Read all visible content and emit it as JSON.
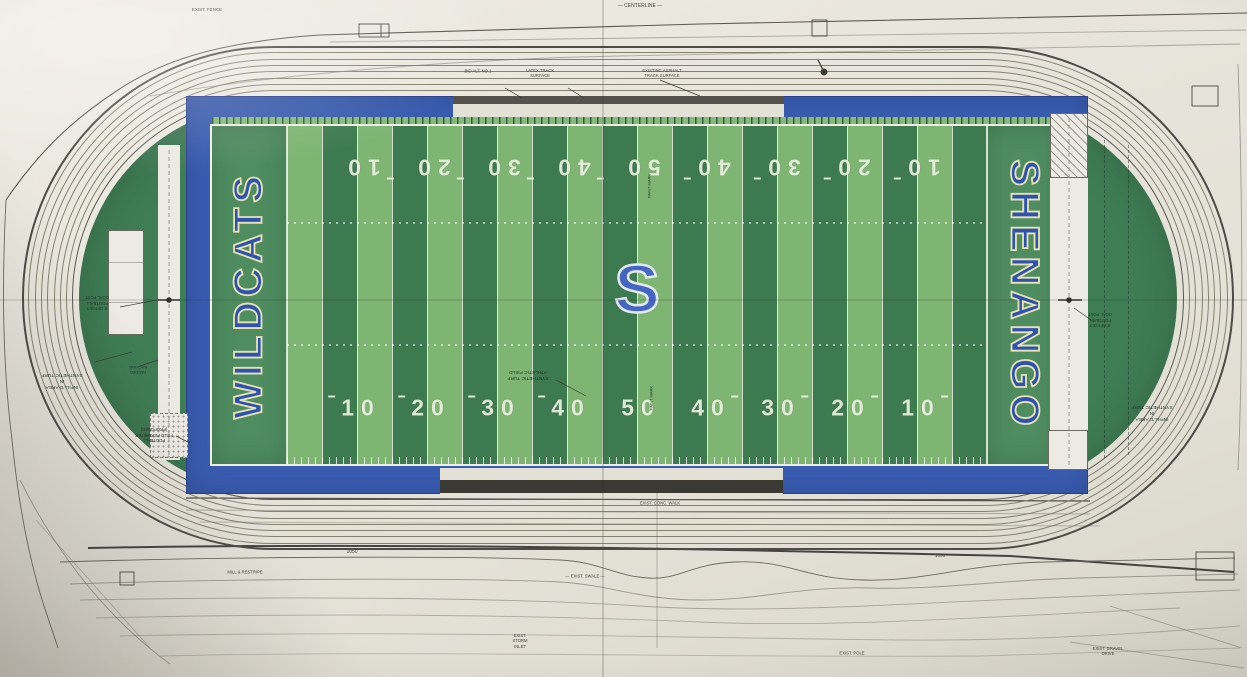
{
  "document": {
    "type": "photographed site plan drawing",
    "subject": "Shenango Wildcats football field and running track"
  },
  "field": {
    "left_endzone_text": "WILDCATS",
    "right_endzone_text": "SHENANGO",
    "center_logo_letter": "S",
    "yard_numbers_top": [
      "10",
      "20",
      "30",
      "40",
      "50",
      "40",
      "30",
      "20",
      "10"
    ],
    "yard_numbers_bottom": [
      "10",
      "20",
      "30",
      "40",
      "50",
      "40",
      "30",
      "20",
      "10"
    ],
    "colors": {
      "stripe_light": "#7eb573",
      "stripe_dark": "#3e7a50",
      "endzone_green": "#4f8c60",
      "infield_green": "#3f7d55",
      "apron_blue": "#3a5db2",
      "letter_blue": "#2d52b4",
      "letter_outline": "#e8e2b0",
      "logo_blue": "#4565c5",
      "line_white": "#f0efe6"
    }
  },
  "track": {
    "lane_count": 8,
    "lane_line_color": "#85836f"
  },
  "icons": [
    {
      "name": "goal-post-icon",
      "meaning": "football goal post plan symbol"
    },
    {
      "name": "benchmark-icon",
      "meaning": "survey benchmark dot"
    }
  ],
  "annotations": [
    {
      "text": "— CENTERLINE —",
      "x": 640,
      "y": 6,
      "rot": 0,
      "size": 5,
      "color": "#45443c"
    },
    {
      "text": "EXIST. FENCE",
      "x": 207,
      "y": 10,
      "rot": 0,
      "size": 4.5,
      "color": "#45443c"
    },
    {
      "text": "BID ALT. NO.1",
      "x": 478,
      "y": 71,
      "rot": 0,
      "size": 4.2,
      "color": "#45443c"
    },
    {
      "text": "LATEX TRACK\nSURFACE",
      "x": 540,
      "y": 73,
      "rot": 0,
      "size": 4.2,
      "color": "#45443c"
    },
    {
      "text": "EXISTING ASPHALT\nTRACK SURFACE",
      "x": 662,
      "y": 73,
      "rot": 0,
      "size": 4.2,
      "color": "#45443c"
    },
    {
      "text": "1050",
      "x": 352,
      "y": 552,
      "rot": 0,
      "size": 5,
      "color": "#45443c"
    },
    {
      "text": "1050",
      "x": 940,
      "y": 556,
      "rot": 0,
      "size": 4.5,
      "color": "#45443c"
    },
    {
      "text": "INFILL'D AREA\nIN\nSYNTHETIC TURF",
      "x": 62,
      "y": 380,
      "rot": 180,
      "size": 4.8,
      "color": "#223a2c"
    },
    {
      "text": "INFILL'D AREA\nIN\nSYNTHETIC TURF",
      "x": 1152,
      "y": 412,
      "rot": 180,
      "size": 4.8,
      "color": "#223a2c"
    },
    {
      "text": "SYNTHETIC TURF\nATHLETIC FIELD",
      "x": 528,
      "y": 374,
      "rot": 180,
      "size": 4.8,
      "color": "#1d3226"
    },
    {
      "text": "8' OFFSET\nFOOTBALL\nGOAL POST",
      "x": 97,
      "y": 303,
      "rot": 180,
      "size": 4.2,
      "color": "#223a2c"
    },
    {
      "text": "8' OFFSET\nFOOTBALL\nGOAL POST",
      "x": 1100,
      "y": 320,
      "rot": 180,
      "size": 4.2,
      "color": "#223a2c"
    },
    {
      "text": "FOOTBALL\nFIELD PERIMETER\n(PROPOSED)",
      "x": 154,
      "y": 435,
      "rot": 180,
      "size": 4.2,
      "color": "#2a2a24"
    },
    {
      "text": "PADDED\nBACKING",
      "x": 138,
      "y": 370,
      "rot": 180,
      "size": 4,
      "color": "#223a2c"
    },
    {
      "text": "PAINT MARK",
      "x": 651,
      "y": 398,
      "rot": -90,
      "size": 4,
      "color": "#1d3226"
    },
    {
      "text": "PAINT MARK",
      "x": 649,
      "y": 186,
      "rot": -90,
      "size": 4,
      "color": "#1d3226"
    },
    {
      "text": "— EXIST. SWALE —",
      "x": 585,
      "y": 576,
      "rot": 0,
      "size": 4.2,
      "color": "#45443c"
    },
    {
      "text": "MILL & RESTRIPE",
      "x": 245,
      "y": 572,
      "rot": 0,
      "size": 4.2,
      "color": "#45443c"
    },
    {
      "text": "EXIST. CONC. WALK",
      "x": 660,
      "y": 503,
      "rot": 0,
      "size": 4.2,
      "color": "#45443c"
    },
    {
      "text": "EXIST.\nSTORM\nINLET",
      "x": 520,
      "y": 641,
      "rot": 0,
      "size": 4.2,
      "color": "#45443c"
    },
    {
      "text": "EXIST. POLE",
      "x": 852,
      "y": 653,
      "rot": 0,
      "size": 4.2,
      "color": "#45443c"
    },
    {
      "text": "EXIST. GRAVEL\nDRIVE",
      "x": 1108,
      "y": 651,
      "rot": 0,
      "size": 4.2,
      "color": "#45443c"
    }
  ]
}
